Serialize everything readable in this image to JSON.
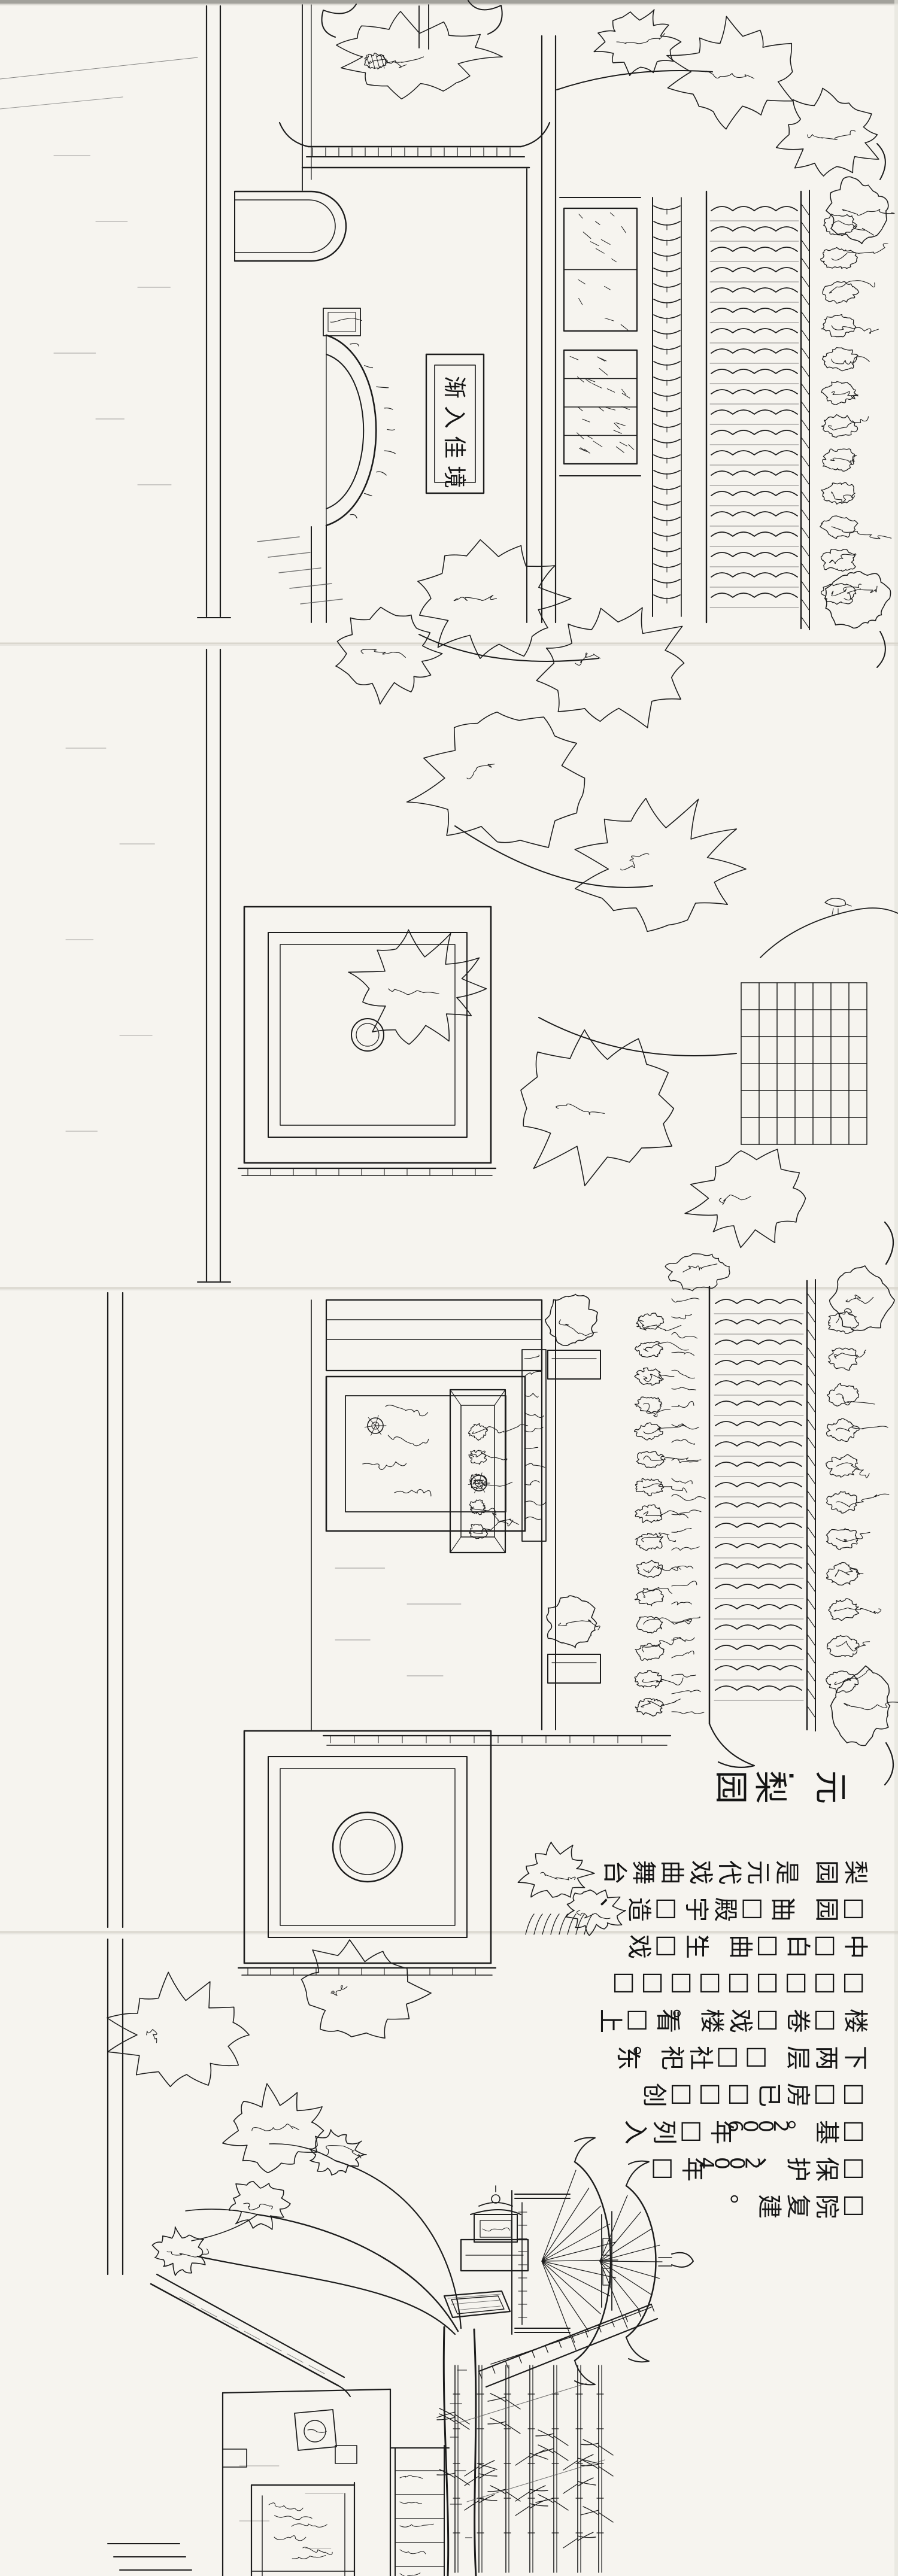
{
  "artwork": {
    "title": "元·梨园",
    "gate_plaque_text": "渐入佳境",
    "inscription_columns": [
      "梨园 是元代戏曲舞台",
      "□园、曲□殿宇□造、",
      "中□白□曲、生□戏",
      "□□□□□□□□□",
      "楼□卷□戏楼。看□上",
      "下两层 □□社祀。东",
      "□□房已□□□创",
      "□基。2006年□列入",
      "□保护、2004年□",
      "□院复建。"
    ]
  },
  "colors": {
    "paper": "#f6f4ef",
    "ink": "#1c1c1c",
    "faint_ink": "#555555",
    "seam": "#d9d6cd",
    "edge_shadow": "#8d8c86"
  }
}
